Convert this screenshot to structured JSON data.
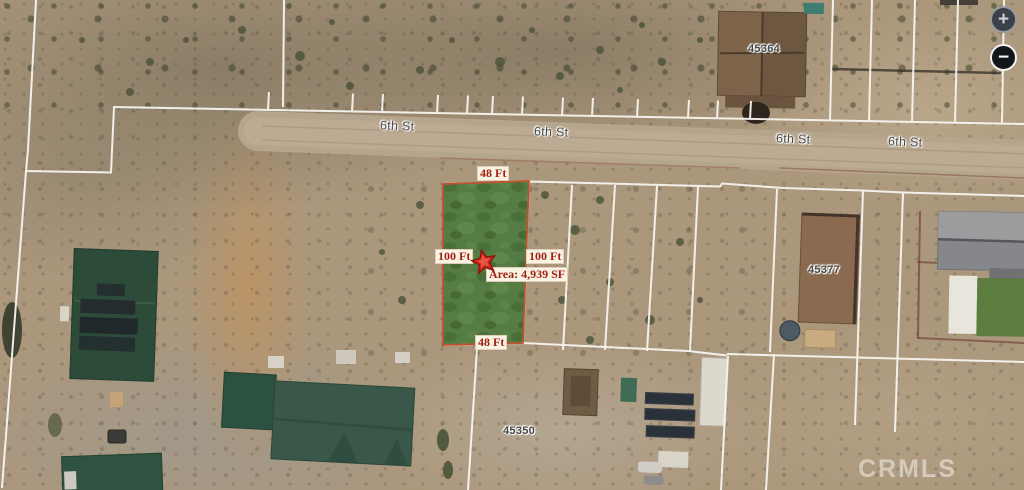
{
  "map": {
    "description": "Aerial parcel map with highlighted subject lot",
    "streets": [
      {
        "label": "6th St"
      },
      {
        "label": "6th St"
      },
      {
        "label": "6th St"
      },
      {
        "label": "6th St"
      }
    ],
    "parcel_numbers": [
      {
        "label": "45364"
      },
      {
        "label": "45377"
      },
      {
        "label": "45350"
      }
    ],
    "subject_parcel": {
      "top_width": "48 Ft",
      "left_length": "100 Ft",
      "right_length": "100 Ft",
      "area": "Area: 4,939 SF",
      "bottom_width": "48 Ft",
      "marker_icon": "red-star",
      "fill_color": "#4e7b3e",
      "border_color": "#c0512f",
      "label_color": "#a32014",
      "label_bg": "#f8f3e2"
    },
    "controls": {
      "zoom_in": "+",
      "zoom_out": "−"
    },
    "watermark": "CRMLS",
    "colors": {
      "terrain": "#ab977c",
      "road": "#b4a38b",
      "parcel_line": "#f7f5f0",
      "street_label": "#4a4a4a"
    }
  }
}
